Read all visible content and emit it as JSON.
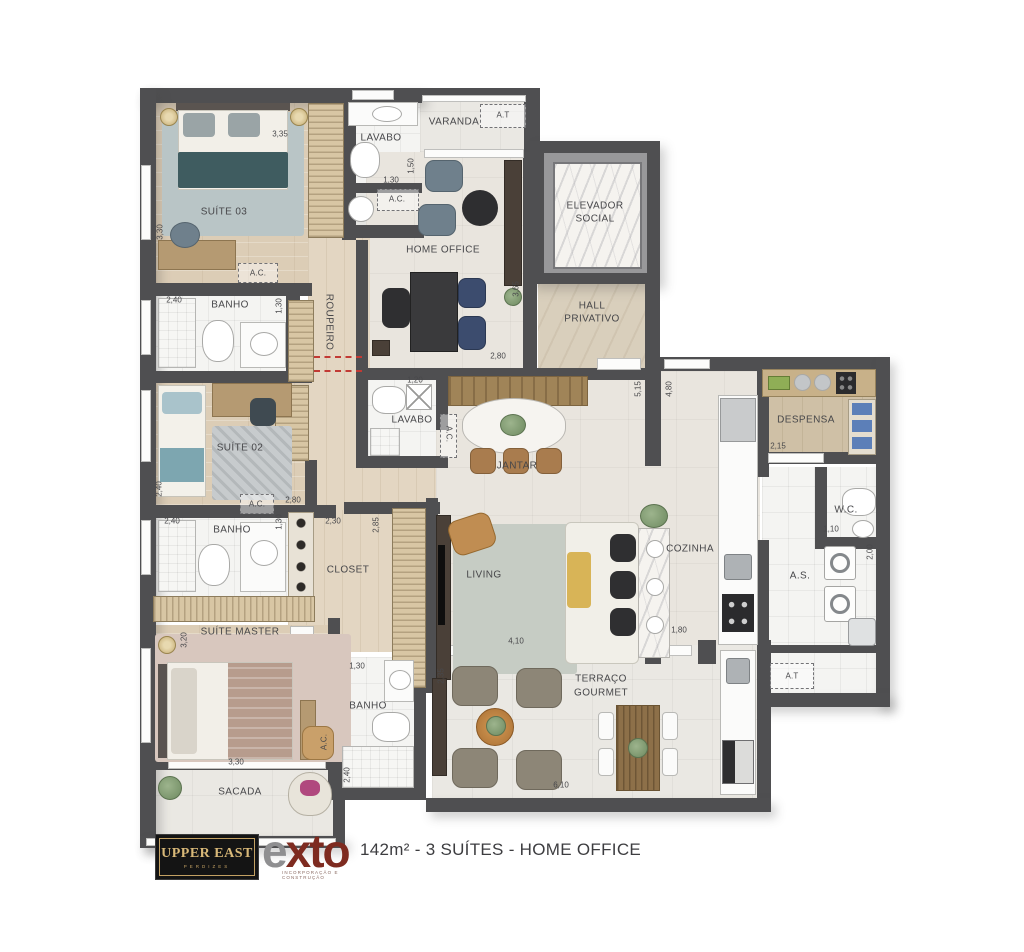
{
  "caption": "142m² - 3 SUÍTES - HOME OFFICE",
  "branding": {
    "upper_east": {
      "name": "UPPER EAST",
      "district": "PERDIZES"
    },
    "exto": {
      "e": "e",
      "x": "x",
      "to": "to",
      "tagline": "INCORPORAÇÃO E CONSTRUÇÃO"
    }
  },
  "labels": {
    "suite03": "SUÍTE 03",
    "suite02": "SUÍTE 02",
    "suite_master": "SUÍTE MASTER",
    "lavabo": "LAVABO",
    "banho": "BANHO",
    "ac": "A.C.",
    "at": "A.T",
    "varanda": "VARANDA",
    "home_office": "HOME OFFICE",
    "elevador_l1": "ELEVADOR",
    "elevador_l2": "SOCIAL",
    "hall_l1": "HALL",
    "hall_l2": "PRIVATIVO",
    "roupeiro": "ROUPEIRO",
    "jantar": "JANTAR",
    "living": "LIVING",
    "cozinha": "COZINHA",
    "despensa": "DESPENSA",
    "wc": "W.C.",
    "as": "A.S.",
    "closet": "CLOSET",
    "sacada": "SACADA",
    "terraco_l1": "TERRAÇO",
    "terraco_l2": "GOURMET"
  },
  "dims": [
    "3,35",
    "3,30",
    "1,30",
    "1,50",
    "2,40",
    "1,30",
    "2,40",
    "2,80",
    "1,20",
    "2,80",
    "3,65",
    "5,15",
    "4,80",
    "2,15",
    "1,10",
    "2,00",
    "2,40",
    "1,30",
    "2,30",
    "2,85",
    "3,20",
    "3,30",
    "1,30",
    "2,40",
    "4,10",
    "2,35",
    "1,80",
    "6,10"
  ],
  "colors": {
    "wall": "#4f4f51",
    "wood_floor": "#dccdb6",
    "tile_floor": "#f4f4f2",
    "social_floor": "#e9e5de",
    "hall_marble": "#d9cfbc",
    "accent_teal_bed": "#3f5c60",
    "accent_camel": "#c08d52",
    "accent_navy": "#3c4c6e",
    "red_dashed": "#c23a34",
    "logo_gold": "#d8b878",
    "logo_red": "#7e2b20"
  }
}
